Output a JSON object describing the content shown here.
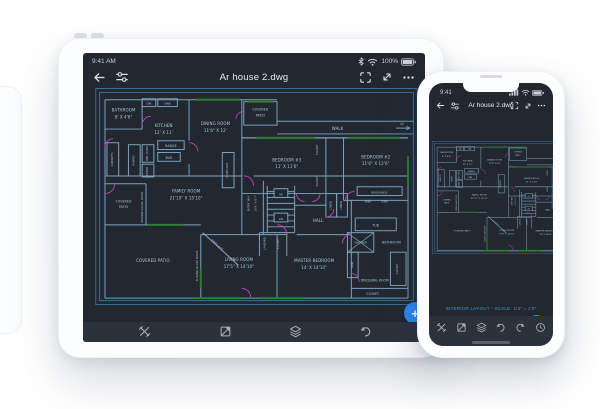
{
  "tablet": {
    "status": {
      "time": "9:41 AM",
      "battery": "100%"
    },
    "titlebar": {
      "title": "Ar house 2.dwg"
    }
  },
  "phone": {
    "status": {
      "time": "9:41"
    },
    "titlebar": {
      "title": "Ar house 2.dwg"
    },
    "caption": "INTERIOR LAYOUT  -  SCALE: 1/4\" = 1'0\"",
    "fab_label": "+"
  },
  "toolbar": {
    "icons": [
      "measure-tool",
      "annotate-tool",
      "layers",
      "undo",
      "redo",
      "more-tools"
    ]
  },
  "colors": {
    "accent_blue": "#2e87f2",
    "screen_background": "#232830",
    "plan_line_blue": "#7ba3bf",
    "door_magenta": "#c341c3",
    "window_green": "#2e7d33",
    "caption_blue": "#4c94ce"
  },
  "floorplan": {
    "bathroom1": "BATHROOM",
    "bathroom1_dim": "8' X 4'6\"",
    "dw": "DW",
    "sink_top": "SINK",
    "kitchen": "KITCHEN",
    "kitchen_dim": "12' X 11'",
    "dining": "DINING ROOM",
    "dining_dim": "11'6\" X 12'",
    "patio_top_1": "COVERED",
    "patio_top_2": "PATIO",
    "walk": "WALK",
    "up": "UP",
    "dn": "DN",
    "range": "RANGE",
    "bar": "BAR",
    "cabinets": "CABINETS",
    "pantry": "PANTRY",
    "dbl_oven": "DBL OVEN",
    "china": "CHINA",
    "family": "FAMILY ROOM",
    "family_dim": "21'10\" X 15'10\"",
    "fireplace1": "FIREPLACE",
    "fireplace2": "FIREPLACE",
    "bedroom3": "BEDROOM #3",
    "bedroom3_dim": "11' X 11'6\"",
    "bedroom2": "BEDROOM #2",
    "bedroom2_dim": "11'6\" X 12'6\"",
    "closet_a": "CLOSET",
    "closet_b": "CLOSET",
    "closet_c": "CLOSET",
    "closet_d": "CLOSET",
    "closet_e": "CLOSET",
    "landing": "LANDING",
    "entry": "ENTRY WAY",
    "entry_dim": "10'9\" X 6'7\"",
    "hall": "HALL",
    "linen_a": "LINEN",
    "linen_b": "LINEN",
    "bookshelf": "BOOKSHELF",
    "sink_a": "SINK",
    "sink_b": "SINK",
    "tub": "TUB",
    "shower": "SHOWER",
    "bathroom2": "BATHROOM",
    "sink_vert": "SINK",
    "master": "MASTER BEDROOM",
    "master_dim": "14' X 14'10\"",
    "dressing": "DRESSING ROOM",
    "living": "LIVING ROOM",
    "living_dim": "17'5\" X 14'10\"",
    "patio_small_1": "COVERED",
    "patio_small_2": "PATIO",
    "patio_big": "COVERED PATIO",
    "sliding_a": "SLIDING GLASS DOOR",
    "sliding_b": "SLIDING GLASS DOOR"
  }
}
